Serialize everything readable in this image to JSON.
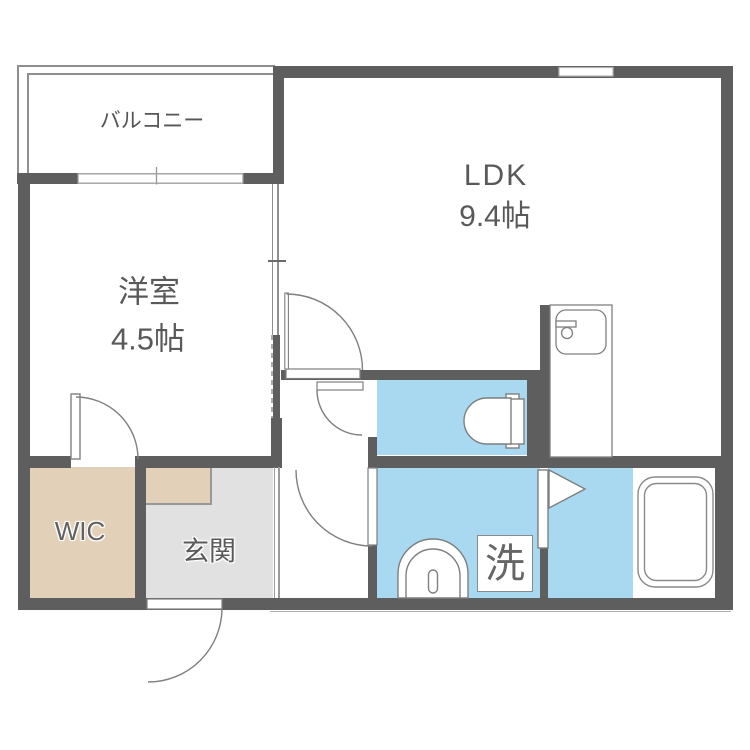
{
  "floorplan": {
    "labels": {
      "balcony": "バルコニー",
      "ldk_name": "LDK",
      "ldk_size": "9.4帖",
      "western_name": "洋室",
      "western_size": "4.5帖",
      "wic": "WIC",
      "entrance": "玄関",
      "laundry": "洗"
    },
    "rooms": [
      {
        "name": "balcony",
        "label": "バルコニー"
      },
      {
        "name": "ldk",
        "label": "LDK",
        "size": "9.4帖"
      },
      {
        "name": "western-room",
        "label": "洋室",
        "size": "4.5帖"
      },
      {
        "name": "walk-in-closet",
        "label": "WIC"
      },
      {
        "name": "entrance",
        "label": "玄関"
      },
      {
        "name": "washroom",
        "label": "洗"
      },
      {
        "name": "toilet",
        "label": ""
      },
      {
        "name": "bathroom",
        "label": ""
      }
    ],
    "fixtures": [
      "toilet-icon",
      "washbasin-icon",
      "washing-machine-space",
      "bathtub-icon",
      "kitchen-sink-icon",
      "bath-door-triangle-icon"
    ],
    "colors": {
      "wall": "#5e5e5e",
      "water_area_floor": "#a8d9f1",
      "wic_floor": "#e2d1b8",
      "entrance_floor": "#e1e1e1",
      "fixture_outline": "#7f7f7f",
      "text": "#595959",
      "background": "#ffffff"
    }
  }
}
